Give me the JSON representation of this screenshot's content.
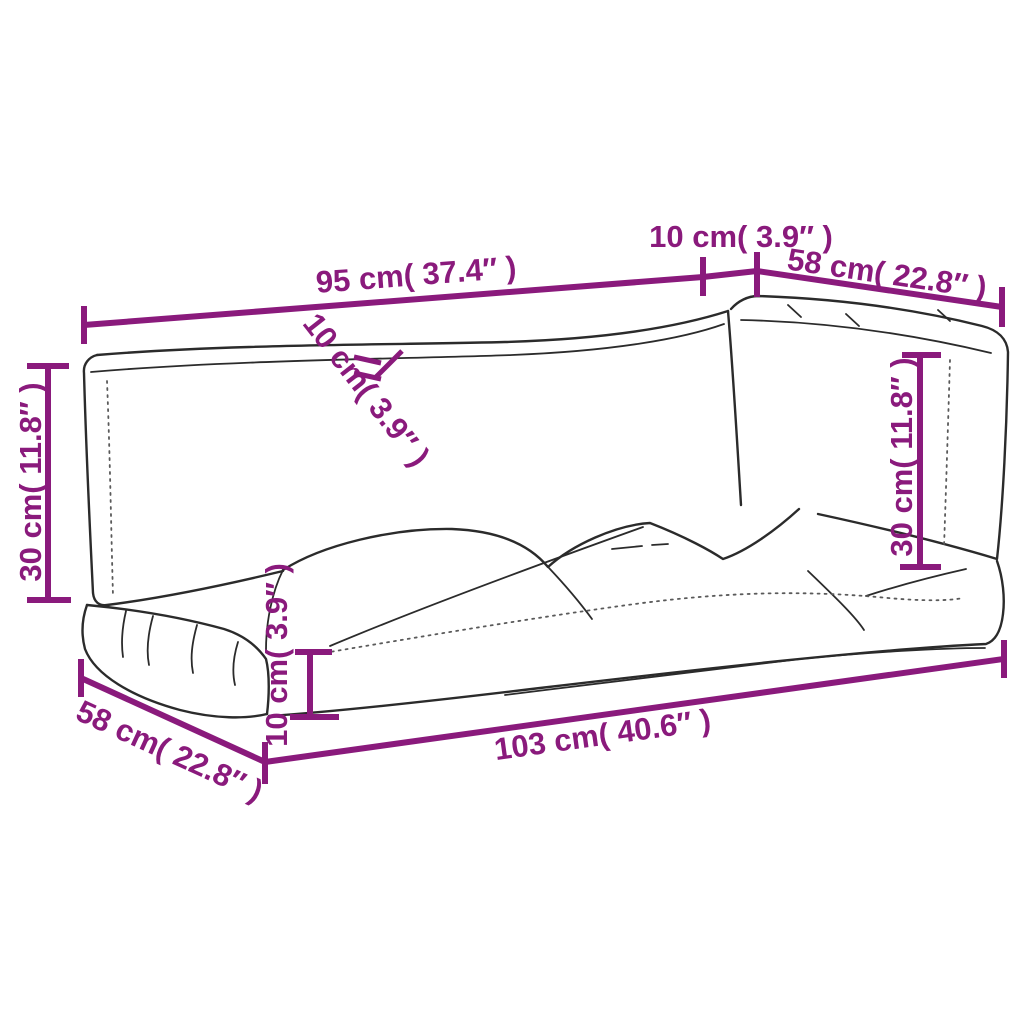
{
  "colors": {
    "dimension": "#8A1A7C",
    "line_art": "#2b2b2b",
    "seam_dotted": "#5a5a5a",
    "background": "#ffffff"
  },
  "figure": {
    "type": "line-drawing",
    "subject": "3-piece pallet sofa cushion set, perspective outline sketch",
    "parts": [
      "back cushion left",
      "back cushion right",
      "large seat cushion",
      "small seat cushion"
    ]
  },
  "dimensions": {
    "back_left_width": {
      "label": "95 cm( 37.4″ )",
      "cm": 95,
      "inches": 37.4
    },
    "back_gap_top": {
      "label": "10 cm( 3.9″ )",
      "cm": 10,
      "inches": 3.9
    },
    "back_right_width": {
      "label": "58 cm( 22.8″ )",
      "cm": 58,
      "inches": 22.8
    },
    "back_left_height": {
      "label": "30 cm( 11.8″ )",
      "cm": 30,
      "inches": 11.8
    },
    "back_left_thickness": {
      "label": "10 cm( 3.9″ )",
      "cm": 10,
      "inches": 3.9
    },
    "back_right_height": {
      "label": "30 cm( 11.8″ )",
      "cm": 30,
      "inches": 11.8
    },
    "seat_thickness": {
      "label": "10 cm( 3.9″ )",
      "cm": 10,
      "inches": 3.9
    },
    "seat_depth": {
      "label": "58 cm( 22.8″ )",
      "cm": 58,
      "inches": 22.8
    },
    "seat_length": {
      "label": "103 cm( 40.6″ )",
      "cm": 103,
      "inches": 40.6
    }
  }
}
